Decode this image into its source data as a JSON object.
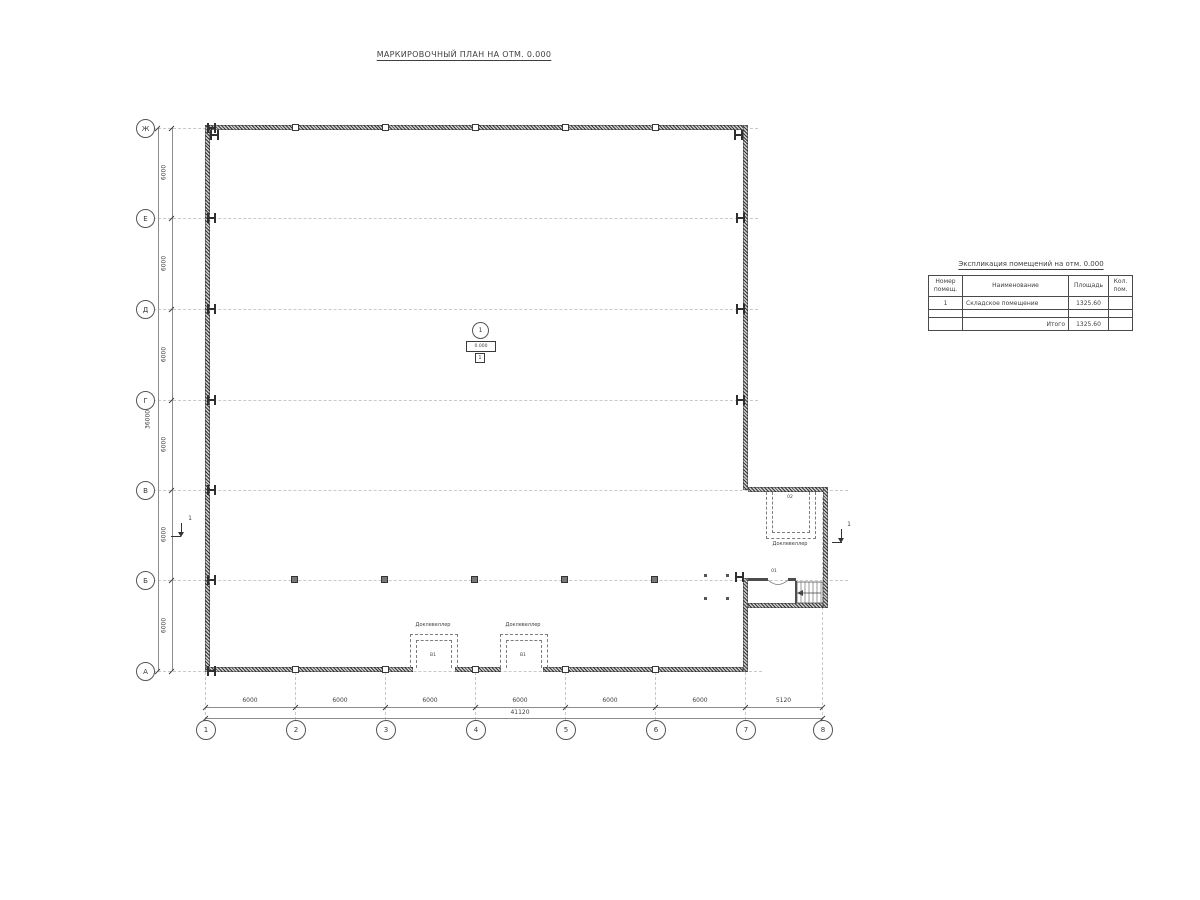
{
  "title": "МАРКИРОВОЧНЫЙ ПЛАН НА ОТМ. 0.000",
  "axes": {
    "row_labels": [
      "Ж",
      "Е",
      "Д",
      "Г",
      "В",
      "Б",
      "А"
    ],
    "row_dims": [
      "6000",
      "6000",
      "6000",
      "6000",
      "6000",
      "6000"
    ],
    "row_total": "36000",
    "col_labels": [
      "1",
      "2",
      "3",
      "4",
      "5",
      "6",
      "7",
      "8"
    ],
    "col_dims": [
      "6000",
      "6000",
      "6000",
      "6000",
      "6000",
      "6000",
      "5120"
    ],
    "col_total": "41120"
  },
  "room_mark": {
    "number": "1",
    "elevation": "0.000",
    "floor_type": "1"
  },
  "dock_levelers": {
    "label": "Доклевеллер",
    "marks": [
      "В1",
      "В1"
    ]
  },
  "annex": {
    "room_upper": "02",
    "room_lower": "01"
  },
  "section_mark": "1",
  "explication": {
    "title": "Экспликация помещений на отм. 0.000",
    "headers": [
      "Номер\nпомещ.",
      "Наименование",
      "Площадь",
      "Кол.\nпом."
    ],
    "rows": [
      [
        "1",
        "Складское помещение",
        "1325.60",
        ""
      ],
      [
        "",
        "",
        "",
        ""
      ],
      [
        "",
        "Итого",
        "1325.60",
        ""
      ]
    ]
  },
  "colors": {
    "line": "#8d8d8d",
    "wall": "#3b3b3b",
    "text": "#3f3f3f",
    "axis_dash": "#c9c9c9"
  }
}
